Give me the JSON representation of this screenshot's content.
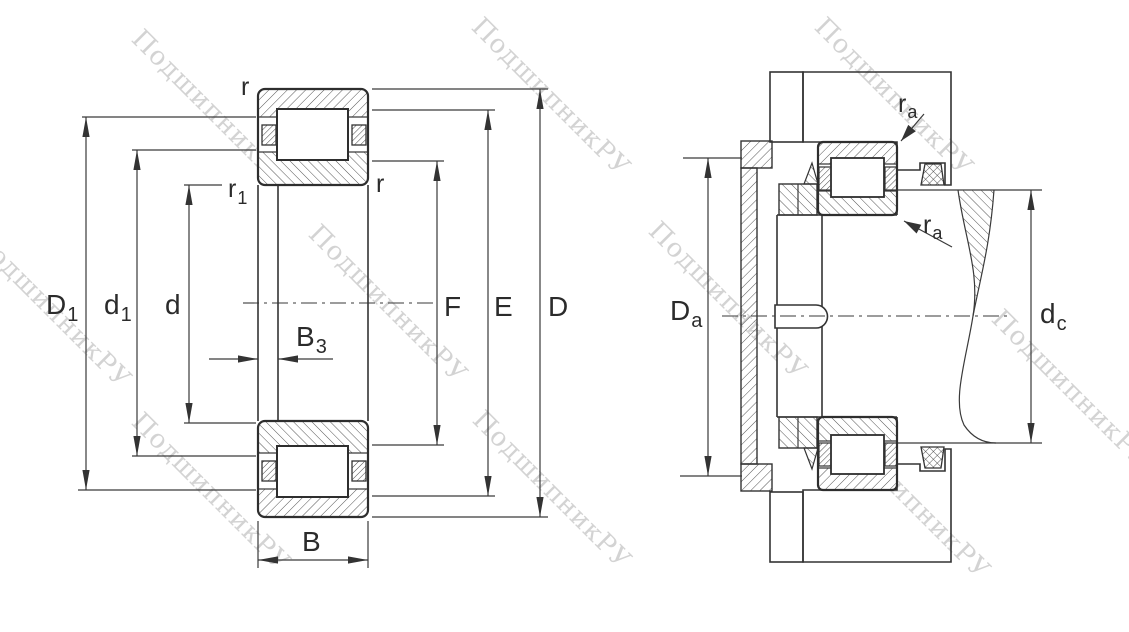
{
  "watermark": {
    "text": "ПодшипникРУ",
    "color": "#c9c9c9"
  },
  "left": {
    "labels": {
      "r_top": "r",
      "r1": {
        "main": "r",
        "sub": "1"
      },
      "r_right": "r",
      "D1": {
        "main": "D",
        "sub": "1"
      },
      "d1": {
        "main": "d",
        "sub": "1"
      },
      "d": "d",
      "B3": {
        "main": "B",
        "sub": "3"
      },
      "B": "B",
      "F": "F",
      "E": "E",
      "D": "D"
    }
  },
  "right": {
    "labels": {
      "ra_top": {
        "main": "r",
        "sub": "a"
      },
      "ra_mid": {
        "main": "r",
        "sub": "a"
      },
      "Da": {
        "main": "D",
        "sub": "a"
      },
      "dc": {
        "main": "d",
        "sub": "c"
      }
    }
  },
  "colors": {
    "line": "#3a3a3a",
    "label": "#2b2b2b",
    "hatch": "#555555",
    "background": "#ffffff"
  }
}
